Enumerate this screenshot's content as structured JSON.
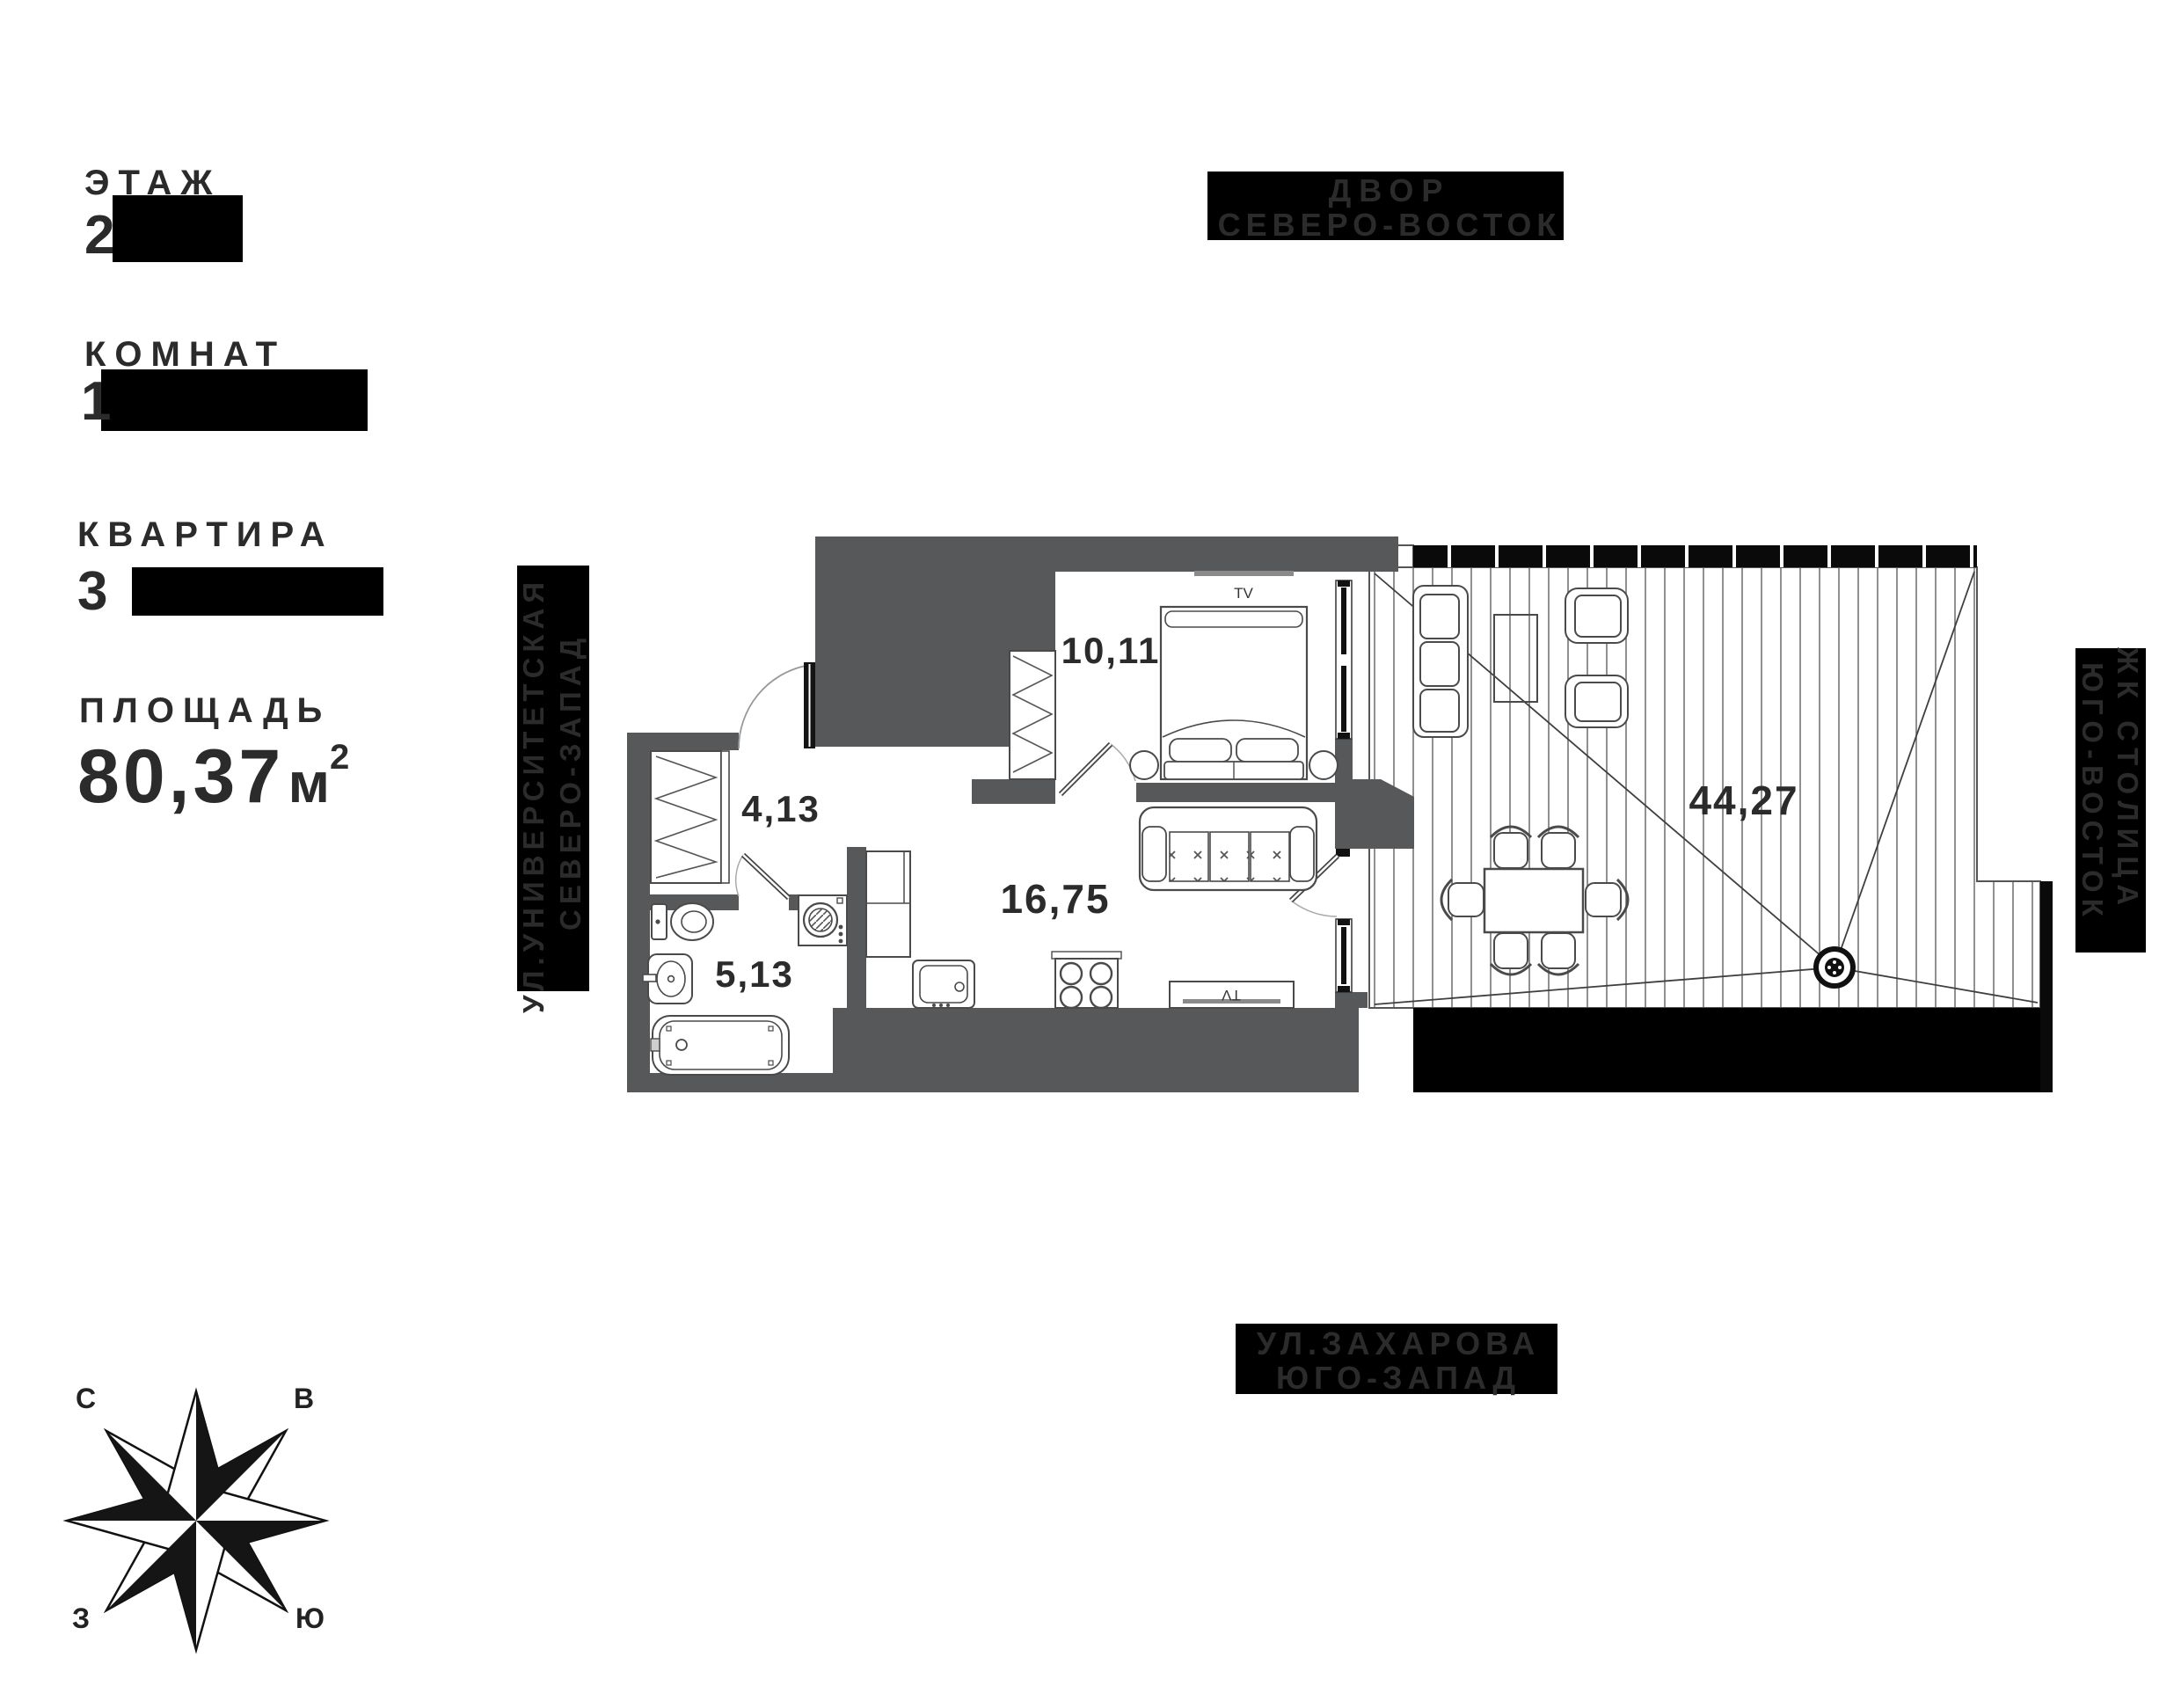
{
  "info_panel": {
    "floor_label": "ЭТАЖ",
    "floor_value": "2",
    "rooms_label": "КОМНАТ",
    "rooms_value": "1",
    "apartment_label": "КВАРТИРА",
    "apartment_value": "3",
    "area_label": "ПЛОЩАДЬ",
    "area_value": "80,37",
    "area_unit": "м",
    "area_sup": "2"
  },
  "orientation_labels": {
    "top": {
      "line1": "ДВОР",
      "line2": "СЕВЕРО-ВОСТОК"
    },
    "bottom": {
      "line1": "УЛ.ЗАХАРОВА",
      "line2": "ЮГО-ЗАПАД"
    },
    "left": {
      "line1": "УЛ.УНИВЕРСИТЕТСКАЯ",
      "line2": "СЕВЕРО-ЗАПАД"
    },
    "right": {
      "line1": "ЖК СТОЛИЦА",
      "line2": "ЮГО-ВОСТОК"
    }
  },
  "compass": {
    "north": "С",
    "east": "В",
    "south": "Ю",
    "west": "З"
  },
  "plan": {
    "rooms": [
      {
        "name": "bedroom",
        "area": "10,11"
      },
      {
        "name": "hallway",
        "area": "4,13"
      },
      {
        "name": "bathroom",
        "area": "5,13"
      },
      {
        "name": "kitchen-living",
        "area": "16,75"
      },
      {
        "name": "terrace",
        "area": "44,27"
      }
    ],
    "tv_label": "TV",
    "colors": {
      "wall": "#57585a",
      "box": "#000000",
      "text": "#2b2b2b",
      "line": "#4a4a4a"
    }
  }
}
